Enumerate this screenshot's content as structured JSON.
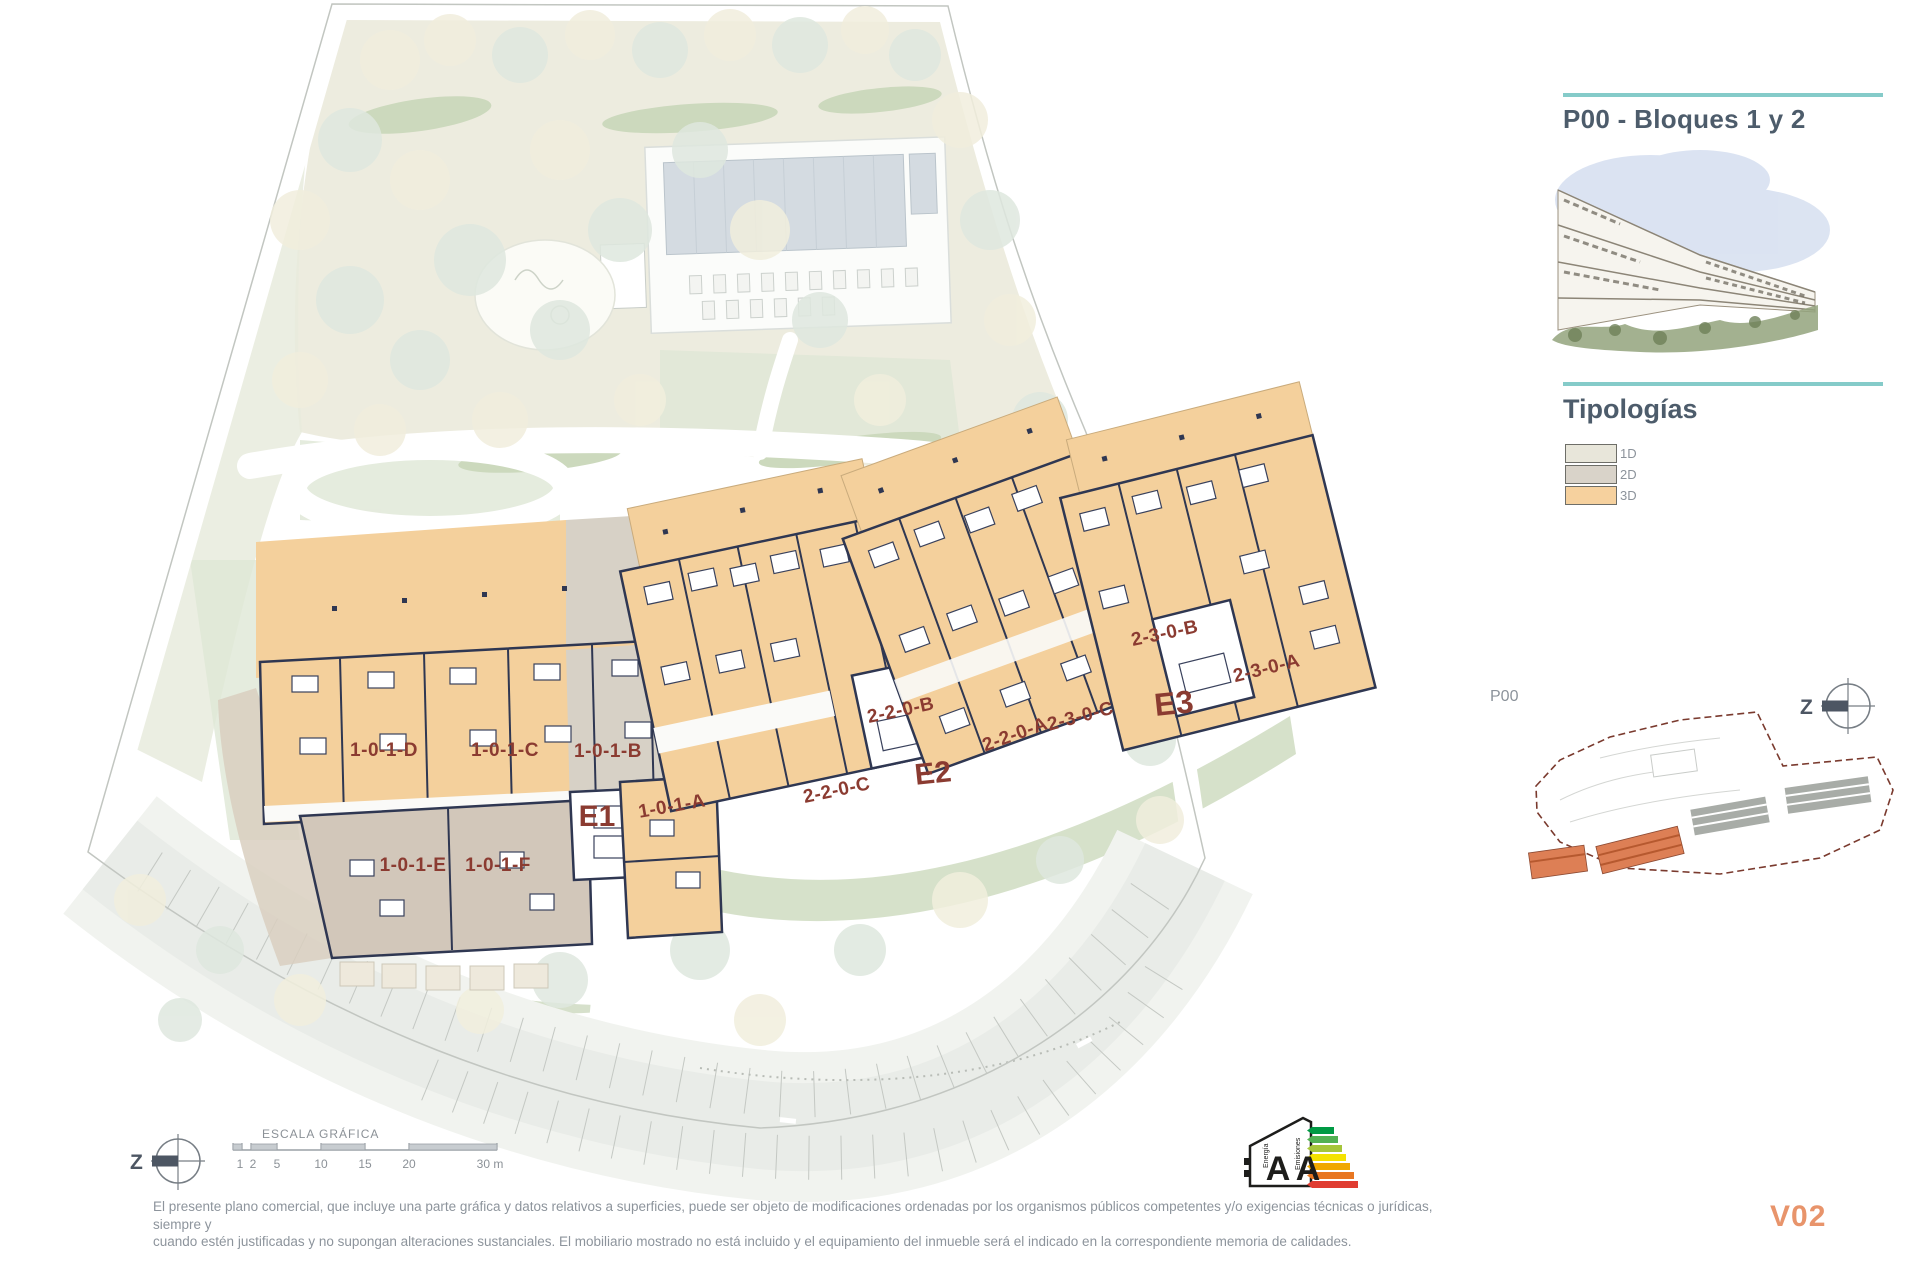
{
  "header": {
    "title": "P00 - Bloques 1 y 2"
  },
  "typologies": {
    "title": "Tipologías",
    "items": [
      {
        "label": "1D",
        "color": "#e8e6da"
      },
      {
        "label": "2D",
        "color": "#d9d3c9"
      },
      {
        "label": "3D",
        "color": "#f6d19e"
      }
    ]
  },
  "minimap": {
    "label": "P00"
  },
  "plan": {
    "north": "Z",
    "blocks": {
      "e1": {
        "name": "E1",
        "units": {
          "d": "1-0-1-D",
          "c": "1-0-1-C",
          "b": "1-0-1-B",
          "a": "1-0-1-A",
          "e": "1-0-1-E",
          "f": "1-0-1-F"
        }
      },
      "e2": {
        "name": "E2",
        "units": {
          "b": "2-2-0-B",
          "a": "2-2-0-A",
          "c": "2-2-0-C"
        }
      },
      "e3": {
        "name": "E3",
        "units": {
          "c": "2-3-0-C",
          "b": "2-3-0-B",
          "a": "2-3-0-A"
        }
      }
    }
  },
  "scalebar": {
    "title": "ESCALA GRÁFICA",
    "ticks": [
      "1",
      "2",
      "5",
      "10",
      "15",
      "20",
      "30 m"
    ]
  },
  "energy": {
    "letter1": "A",
    "letter2": "A",
    "axis1": "Energía",
    "axis2": "Emisiones"
  },
  "footer": {
    "disclaimer_line1": "El presente plano comercial, que incluye una parte gráfica y datos relativos a superficies, puede ser objeto de modificaciones ordenadas por los organismos públicos competentes y/o exigencias técnicas o jurídicas, siempre y",
    "disclaimer_line2": "cuando estén justificadas y no supongan alteraciones sustanciales. El mobiliario mostrado no está incluido y el equipamiento del inmueble será el indicado en la correspondiente memoria de calidades.",
    "version": "V02"
  },
  "colors": {
    "accent_teal": "#85cbc9",
    "label_red": "#8b3b31",
    "typology_3d_orange": "#f6d19e",
    "version_orange": "#e8946b",
    "minimap_boundary_red": "#7a3a2e"
  }
}
